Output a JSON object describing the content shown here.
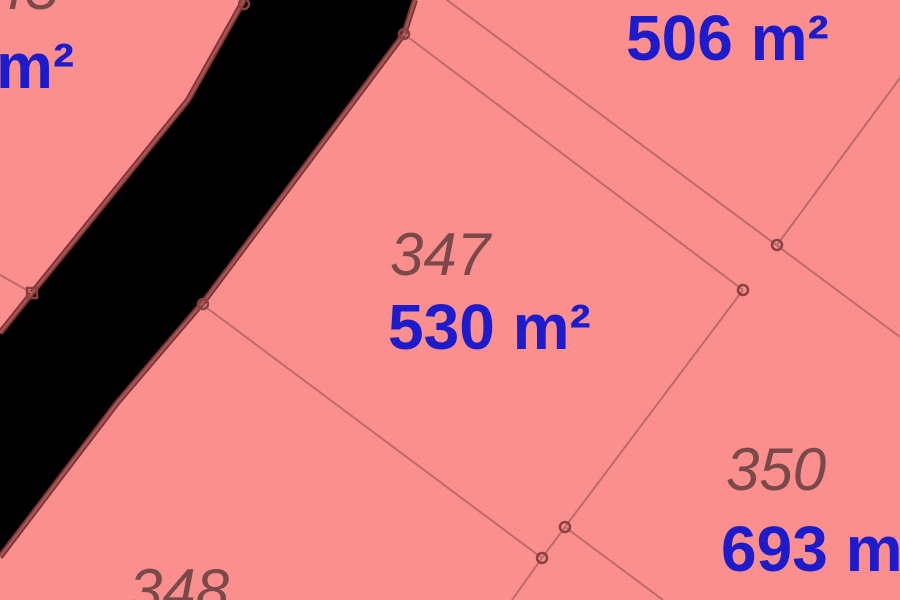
{
  "app": {
    "name": "cadastral-map-view"
  },
  "map": {
    "colors": {
      "parcel_fill": "#fa8f8e",
      "void_fill": "#000000",
      "boundary_thick": "#7c3434",
      "boundary_thick_highlight": "#a85454",
      "boundary_thin": "#b96969",
      "parcel_number": "#7a4a4a",
      "area_label": "#1c1ccd"
    },
    "parcels": {
      "p506": {
        "area_label": "506 m²"
      },
      "p347": {
        "number": "347",
        "area_label": "530 m²"
      },
      "p350": {
        "number": "350",
        "area_label": "693 m²"
      },
      "p348": {
        "number": "348"
      },
      "p_left": {
        "number_fragment": "45",
        "area_label_fragment": "m²"
      }
    }
  }
}
